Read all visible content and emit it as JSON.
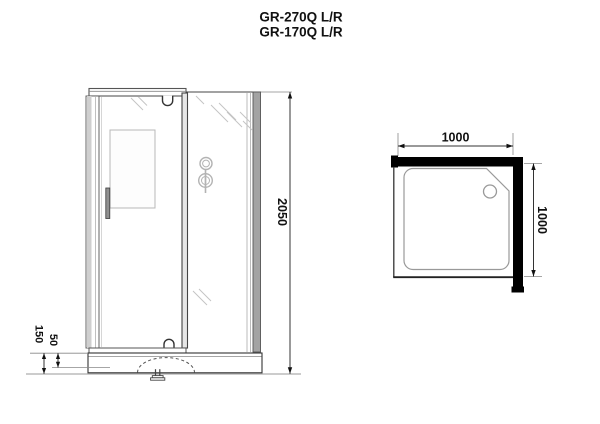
{
  "title": {
    "model_line1": "GR-270Q L/R",
    "model_line2": "GR-170Q L/R"
  },
  "front_view": {
    "dimensions": {
      "overall_height": "2050",
      "tray_height": "150",
      "tray_rim_height": "50"
    }
  },
  "top_view": {
    "dimensions": {
      "width": "1000",
      "depth": "1000"
    }
  },
  "colors": {
    "wall": "#000000",
    "line": "#333333",
    "glass_reflection": "#c4c4c4",
    "fixture": "#b3b3b3"
  }
}
